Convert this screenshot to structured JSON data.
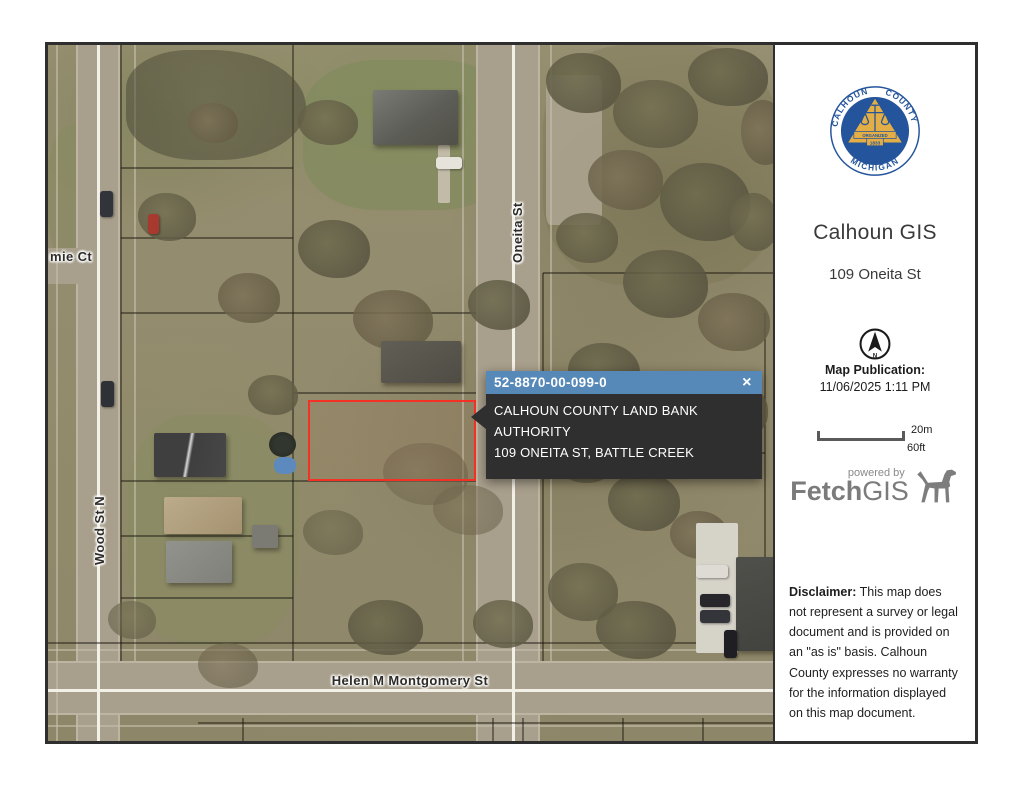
{
  "window": {
    "background": "#ffffff",
    "frame_border": "#2e2e2e"
  },
  "map": {
    "labels": {
      "court_partial": "mie Ct",
      "wood": "Wood St N",
      "oneita": "Oneita St",
      "montgomery": "Helen M Montgomery St"
    },
    "popup": {
      "parcel_id": "52-8870-00-099-0",
      "close": "×",
      "owner": "CALHOUN COUNTY LAND BANK AUTHORITY",
      "address": "109 ONEITA ST, BATTLE CREEK",
      "header_color": "#5688b8",
      "body_color": "#2f2f2f"
    },
    "highlight_color": "#f53126"
  },
  "sidebar": {
    "seal": {
      "arc_left": "CALHOUN",
      "arc_right": "COUNTY",
      "arc_bottom": "MICHIGAN",
      "banner": "ORGANIZED",
      "year": "1833",
      "blue": "#24549b",
      "gold": "#e2ae45"
    },
    "title": "Calhoun GIS",
    "subtitle": "109 Oneita St",
    "north_label": "N",
    "publication_label": "Map Publication:",
    "publication_datetime": "11/06/2025 1:11 PM",
    "scale": {
      "metric": "20m",
      "imperial": "60ft"
    },
    "powered_by": "powered by",
    "brand_bold": "Fetch",
    "brand_light": "GIS",
    "disclaimer_label": "Disclaimer:",
    "disclaimer_text": " This map does not represent a survey or legal document and is provided on an \"as is\" basis. Calhoun County expresses no warranty for the information displayed on this map document."
  }
}
